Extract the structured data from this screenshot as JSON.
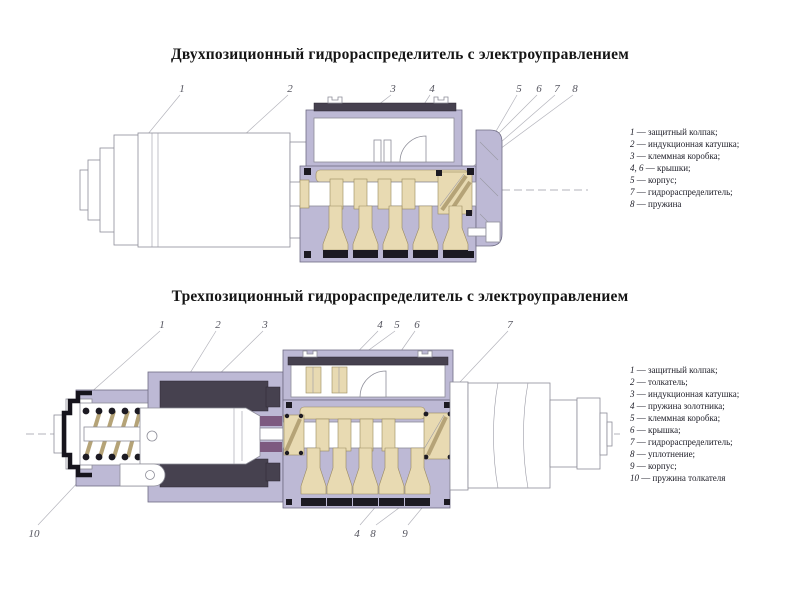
{
  "slide": {
    "background": "#ffffff"
  },
  "palette": {
    "valve_body_lavender": "#bdb9d5",
    "channels_tan": "#e8dab2",
    "coil_dark": "#46414f",
    "seal_black": "#1c1a22",
    "accent_purple": "#7d5a80",
    "outline_gray": "#8d8d98",
    "callout_text": "#55555f"
  },
  "legend_separator": " — ",
  "figures": [
    {
      "title": "Двухпозиционный гидрораспределитель с электроуправлением",
      "callouts": [
        "1",
        "2",
        "3",
        "4",
        "5",
        "6",
        "7",
        "8"
      ],
      "legend": [
        {
          "num": "1",
          "text": "защитный колпак;"
        },
        {
          "num": "2",
          "text": "индукционная катушка;"
        },
        {
          "num": "3",
          "text": "клеммная коробка;"
        },
        {
          "num": "4, 6",
          "text": "крышки;"
        },
        {
          "num": "5",
          "text": "корпус;"
        },
        {
          "num": "7",
          "text": "гидрораспределитель;"
        },
        {
          "num": "8",
          "text": "пружина"
        }
      ]
    },
    {
      "title": "Трехпозиционный гидрораспределитель с электроуправлением",
      "callouts_top": [
        "1",
        "2",
        "3",
        "4",
        "5",
        "6",
        "7"
      ],
      "callouts_bottom": [
        "10",
        "4",
        "8",
        "9"
      ],
      "legend": [
        {
          "num": "1",
          "text": "защитный колпак;"
        },
        {
          "num": "2",
          "text": "толкатель;"
        },
        {
          "num": "3",
          "text": "индукционная катушка;"
        },
        {
          "num": "4",
          "text": "пружина золотника;"
        },
        {
          "num": "5",
          "text": "клеммная коробка;"
        },
        {
          "num": "6",
          "text": "крышка;"
        },
        {
          "num": "7",
          "text": "гидрораспределитель;"
        },
        {
          "num": "8",
          "text": "уплотнение;"
        },
        {
          "num": "9",
          "text": "корпус;"
        },
        {
          "num": "10",
          "text": "пружина толкателя"
        }
      ]
    }
  ]
}
